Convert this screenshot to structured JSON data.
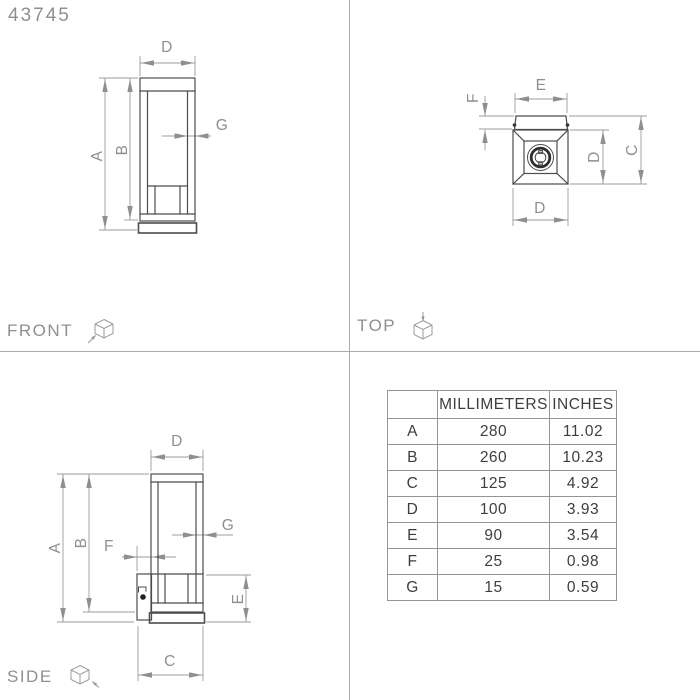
{
  "product_code": "43745",
  "views": {
    "front": {
      "label": "FRONT"
    },
    "top": {
      "label": "TOP"
    },
    "side": {
      "label": "SIDE"
    }
  },
  "dim_labels": {
    "a": "A",
    "b": "B",
    "c": "C",
    "d": "D",
    "e": "E",
    "f": "F",
    "g": "G"
  },
  "table": {
    "headers": {
      "dim": "",
      "mm": "MILLIMETERS",
      "in": "INCHES"
    },
    "rows": [
      {
        "label": "A",
        "mm": "280",
        "in": "11.02"
      },
      {
        "label": "B",
        "mm": "260",
        "in": "10.23"
      },
      {
        "label": "C",
        "mm": "125",
        "in": "4.92"
      },
      {
        "label": "D",
        "mm": "100",
        "in": "3.93"
      },
      {
        "label": "E",
        "mm": "90",
        "in": "3.54"
      },
      {
        "label": "F",
        "mm": "25",
        "in": "0.98"
      },
      {
        "label": "G",
        "mm": "15",
        "in": "0.59"
      }
    ]
  }
}
